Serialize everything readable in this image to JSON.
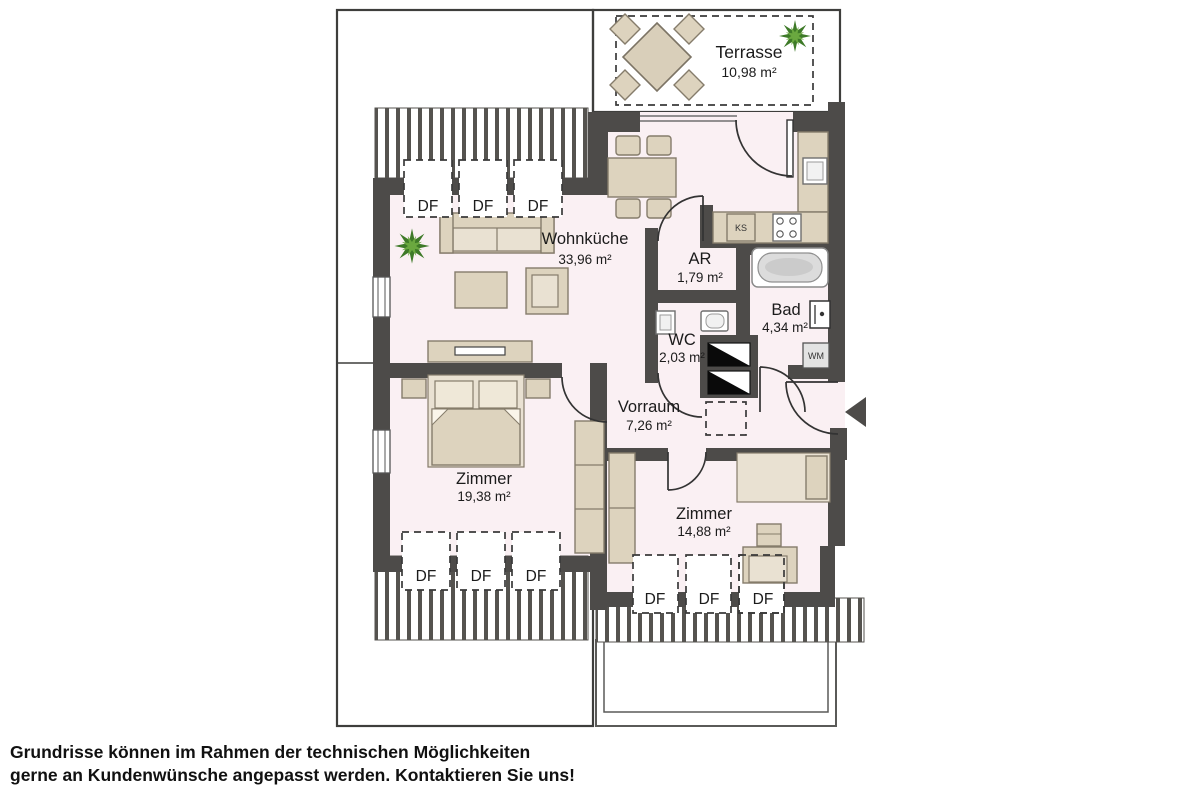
{
  "plan": {
    "rooms": {
      "terrasse": {
        "name": "Terrasse",
        "area": "10,98 m²"
      },
      "wohnkueche": {
        "name": "Wohnküche",
        "area": "33,96 m²"
      },
      "ar": {
        "name": "AR",
        "area": "1,79 m²"
      },
      "wc": {
        "name": "WC",
        "area": "2,03 m²"
      },
      "bad": {
        "name": "Bad",
        "area": "4,34 m²"
      },
      "vorraum": {
        "name": "Vorraum",
        "area": "7,26 m²"
      },
      "zimmer1": {
        "name": "Zimmer",
        "area": "19,38 m²"
      },
      "zimmer2": {
        "name": "Zimmer",
        "area": "14,88 m²"
      }
    },
    "labels": {
      "df": "DF",
      "ks": "KS",
      "wm": "WM"
    },
    "colors": {
      "wall": "#4d4b49",
      "interior_floor": "#faf0f3",
      "outdoor_floor": "#f7ebee",
      "furniture": "#ddd3be",
      "plant_green": "#4e8a2e"
    }
  },
  "footer": {
    "line1": "Grundrisse können im Rahmen der technischen Möglichkeiten",
    "line2": "gerne an Kundenwünsche angepasst werden. Kontaktieren Sie uns!"
  }
}
